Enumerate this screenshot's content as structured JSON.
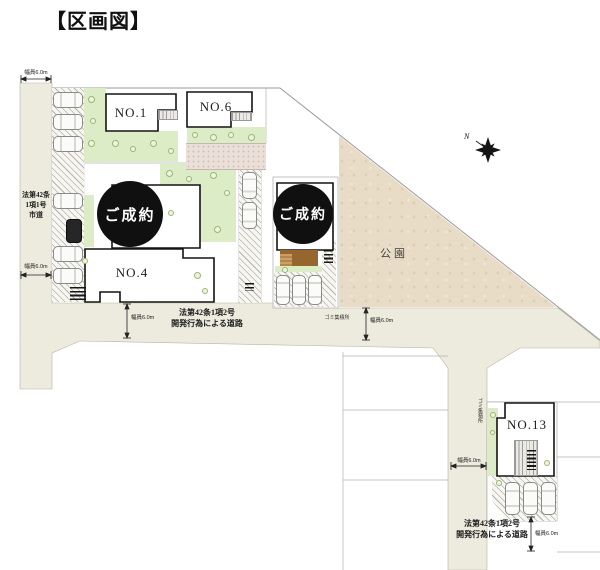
{
  "title": "【区画図】",
  "compass": {
    "north": "N"
  },
  "park": {
    "label": "公園"
  },
  "lots": {
    "no1": "NO.1",
    "no4": "NO.4",
    "no6": "NO.6",
    "no13": "NO.13",
    "sold_left": "ご成約",
    "sold_right": "ご成約"
  },
  "roads": {
    "left": {
      "line1": "法第42条",
      "line2": "1項1号",
      "line3": "市道"
    },
    "bottom": {
      "line1": "法第42条1項2号",
      "line2": "開発行為による道路"
    },
    "southeast": {
      "line1": "法第42条1項2号",
      "line2": "開発行為による道路"
    }
  },
  "width_labels": {
    "left_top": "幅員6.0m",
    "left_mid": "幅員6.0m",
    "bottom_left": "幅員6.0m",
    "park_side": "幅員6.0m",
    "no13_side": "幅員6.0m",
    "no13_bottom": "幅員6.0m"
  },
  "annotations": {
    "garbage_mid": "ゴミ集積所",
    "garbage_no13": "ゴミ集積所"
  },
  "colors": {
    "road": "#ecebdd",
    "park": "#e8dcc7",
    "green": "#dcecc6",
    "sold_badge": "#101010",
    "house_outline": "#141414"
  }
}
